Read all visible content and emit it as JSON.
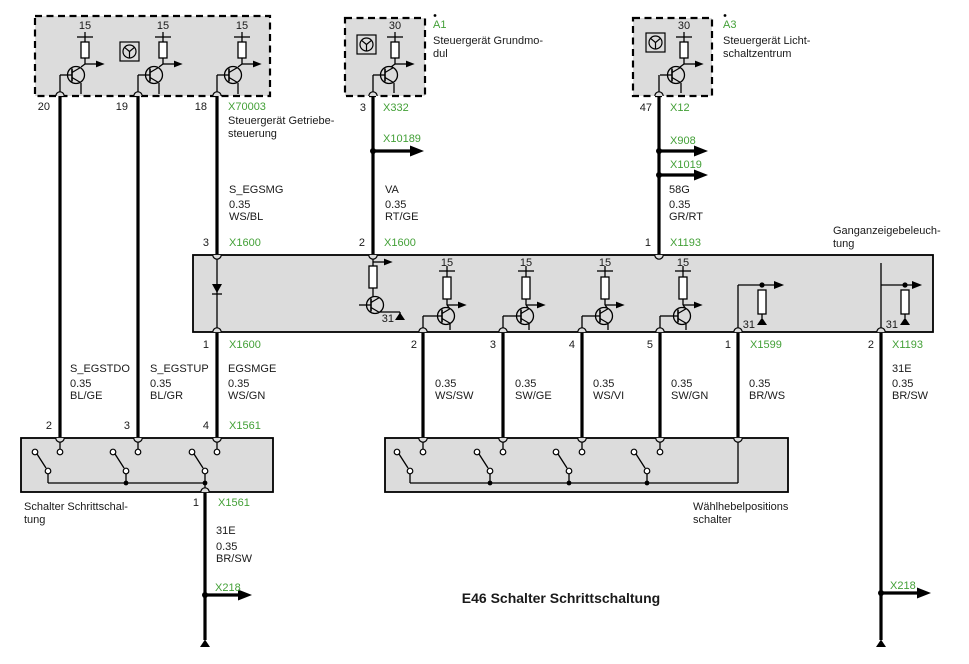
{
  "title": "E46 Schalter Schrittschaltung",
  "colors": {
    "link_green": "#43a037",
    "box_fill": "#dcdcdc",
    "wire_black": "#000000"
  },
  "modules": {
    "getriebesteuerung": {
      "connector": "X70003",
      "pins": [
        "20",
        "19",
        "18"
      ],
      "terminals": [
        "15",
        "15",
        "15"
      ],
      "name": [
        "Steuergerät Getriebe-",
        "steuerung"
      ]
    },
    "grundmodul": {
      "id": "A1",
      "terminal": "30",
      "pin": "3",
      "connector": "X332",
      "name": [
        "Steuergerät Grundmo-",
        "dul"
      ]
    },
    "lichtschaltzentrum": {
      "id": "A3",
      "terminal": "30",
      "pin": "47",
      "connector": "X12",
      "name": [
        "Steuergerät Licht-",
        "schaltzentrum"
      ]
    },
    "ganganzeigebeleuchtung": {
      "name": [
        "Ganganzeigebeleuch-",
        "tung"
      ],
      "terminals": [
        "15",
        "15",
        "15",
        "15"
      ],
      "ground_terminals": [
        "31",
        "31",
        "31"
      ],
      "top_pins": [
        {
          "pin": "3",
          "connector": "X1600"
        },
        {
          "pin": "2",
          "connector": "X1600"
        },
        {
          "pin": "1",
          "connector": "X1193"
        }
      ],
      "bottom_pins": [
        {
          "pin": "1",
          "connector": "X1600"
        },
        {
          "pin": "2"
        },
        {
          "pin": "3"
        },
        {
          "pin": "4"
        },
        {
          "pin": "5"
        },
        {
          "pin": "1",
          "connector": "X1599"
        },
        {
          "pin": "2",
          "connector": "X1193"
        }
      ]
    },
    "schalter_schrittschaltung": {
      "name": [
        "Schalter Schrittschal-",
        "tung"
      ],
      "top_pins": [
        "2",
        "3",
        "4"
      ],
      "top_connector": "X1561",
      "bottom_pin": "1",
      "bottom_connector": "X1561"
    },
    "waehlhebelpositionsschalter": {
      "name": [
        "Wählhebelpositions",
        "schalter"
      ]
    }
  },
  "wires": {
    "s_egsmg": {
      "name": "S_EGSMG",
      "size": "0.35",
      "color": "WS/BL"
    },
    "va": {
      "name": "VA",
      "size": "0.35",
      "color": "RT/GE"
    },
    "g58": {
      "name": "58G",
      "size": "0.35",
      "color": "GR/RT"
    },
    "s_egstdo": {
      "name": "S_EGSTDO",
      "size": "0.35",
      "color": "BL/GE"
    },
    "s_egstup": {
      "name": "S_EGSTUP",
      "size": "0.35",
      "color": "BL/GR"
    },
    "egsmge": {
      "name": "EGSMGE",
      "size": "0.35",
      "color": "WS/GN"
    },
    "ws_sw": {
      "size": "0.35",
      "color": "WS/SW"
    },
    "sw_ge": {
      "size": "0.35",
      "color": "SW/GE"
    },
    "ws_vi": {
      "size": "0.35",
      "color": "WS/VI"
    },
    "sw_gn": {
      "size": "0.35",
      "color": "SW/GN"
    },
    "br_ws": {
      "size": "0.35",
      "color": "BR/WS"
    },
    "e31_switch": {
      "name": "31E",
      "size": "0.35",
      "color": "BR/SW"
    },
    "e31_lamp": {
      "name": "31E",
      "size": "0.35",
      "color": "BR/SW"
    }
  },
  "branches": {
    "x10189": "X10189",
    "x908": "X908",
    "x1019": "X1019",
    "x218_left": "X218",
    "x218_right": "X218"
  }
}
